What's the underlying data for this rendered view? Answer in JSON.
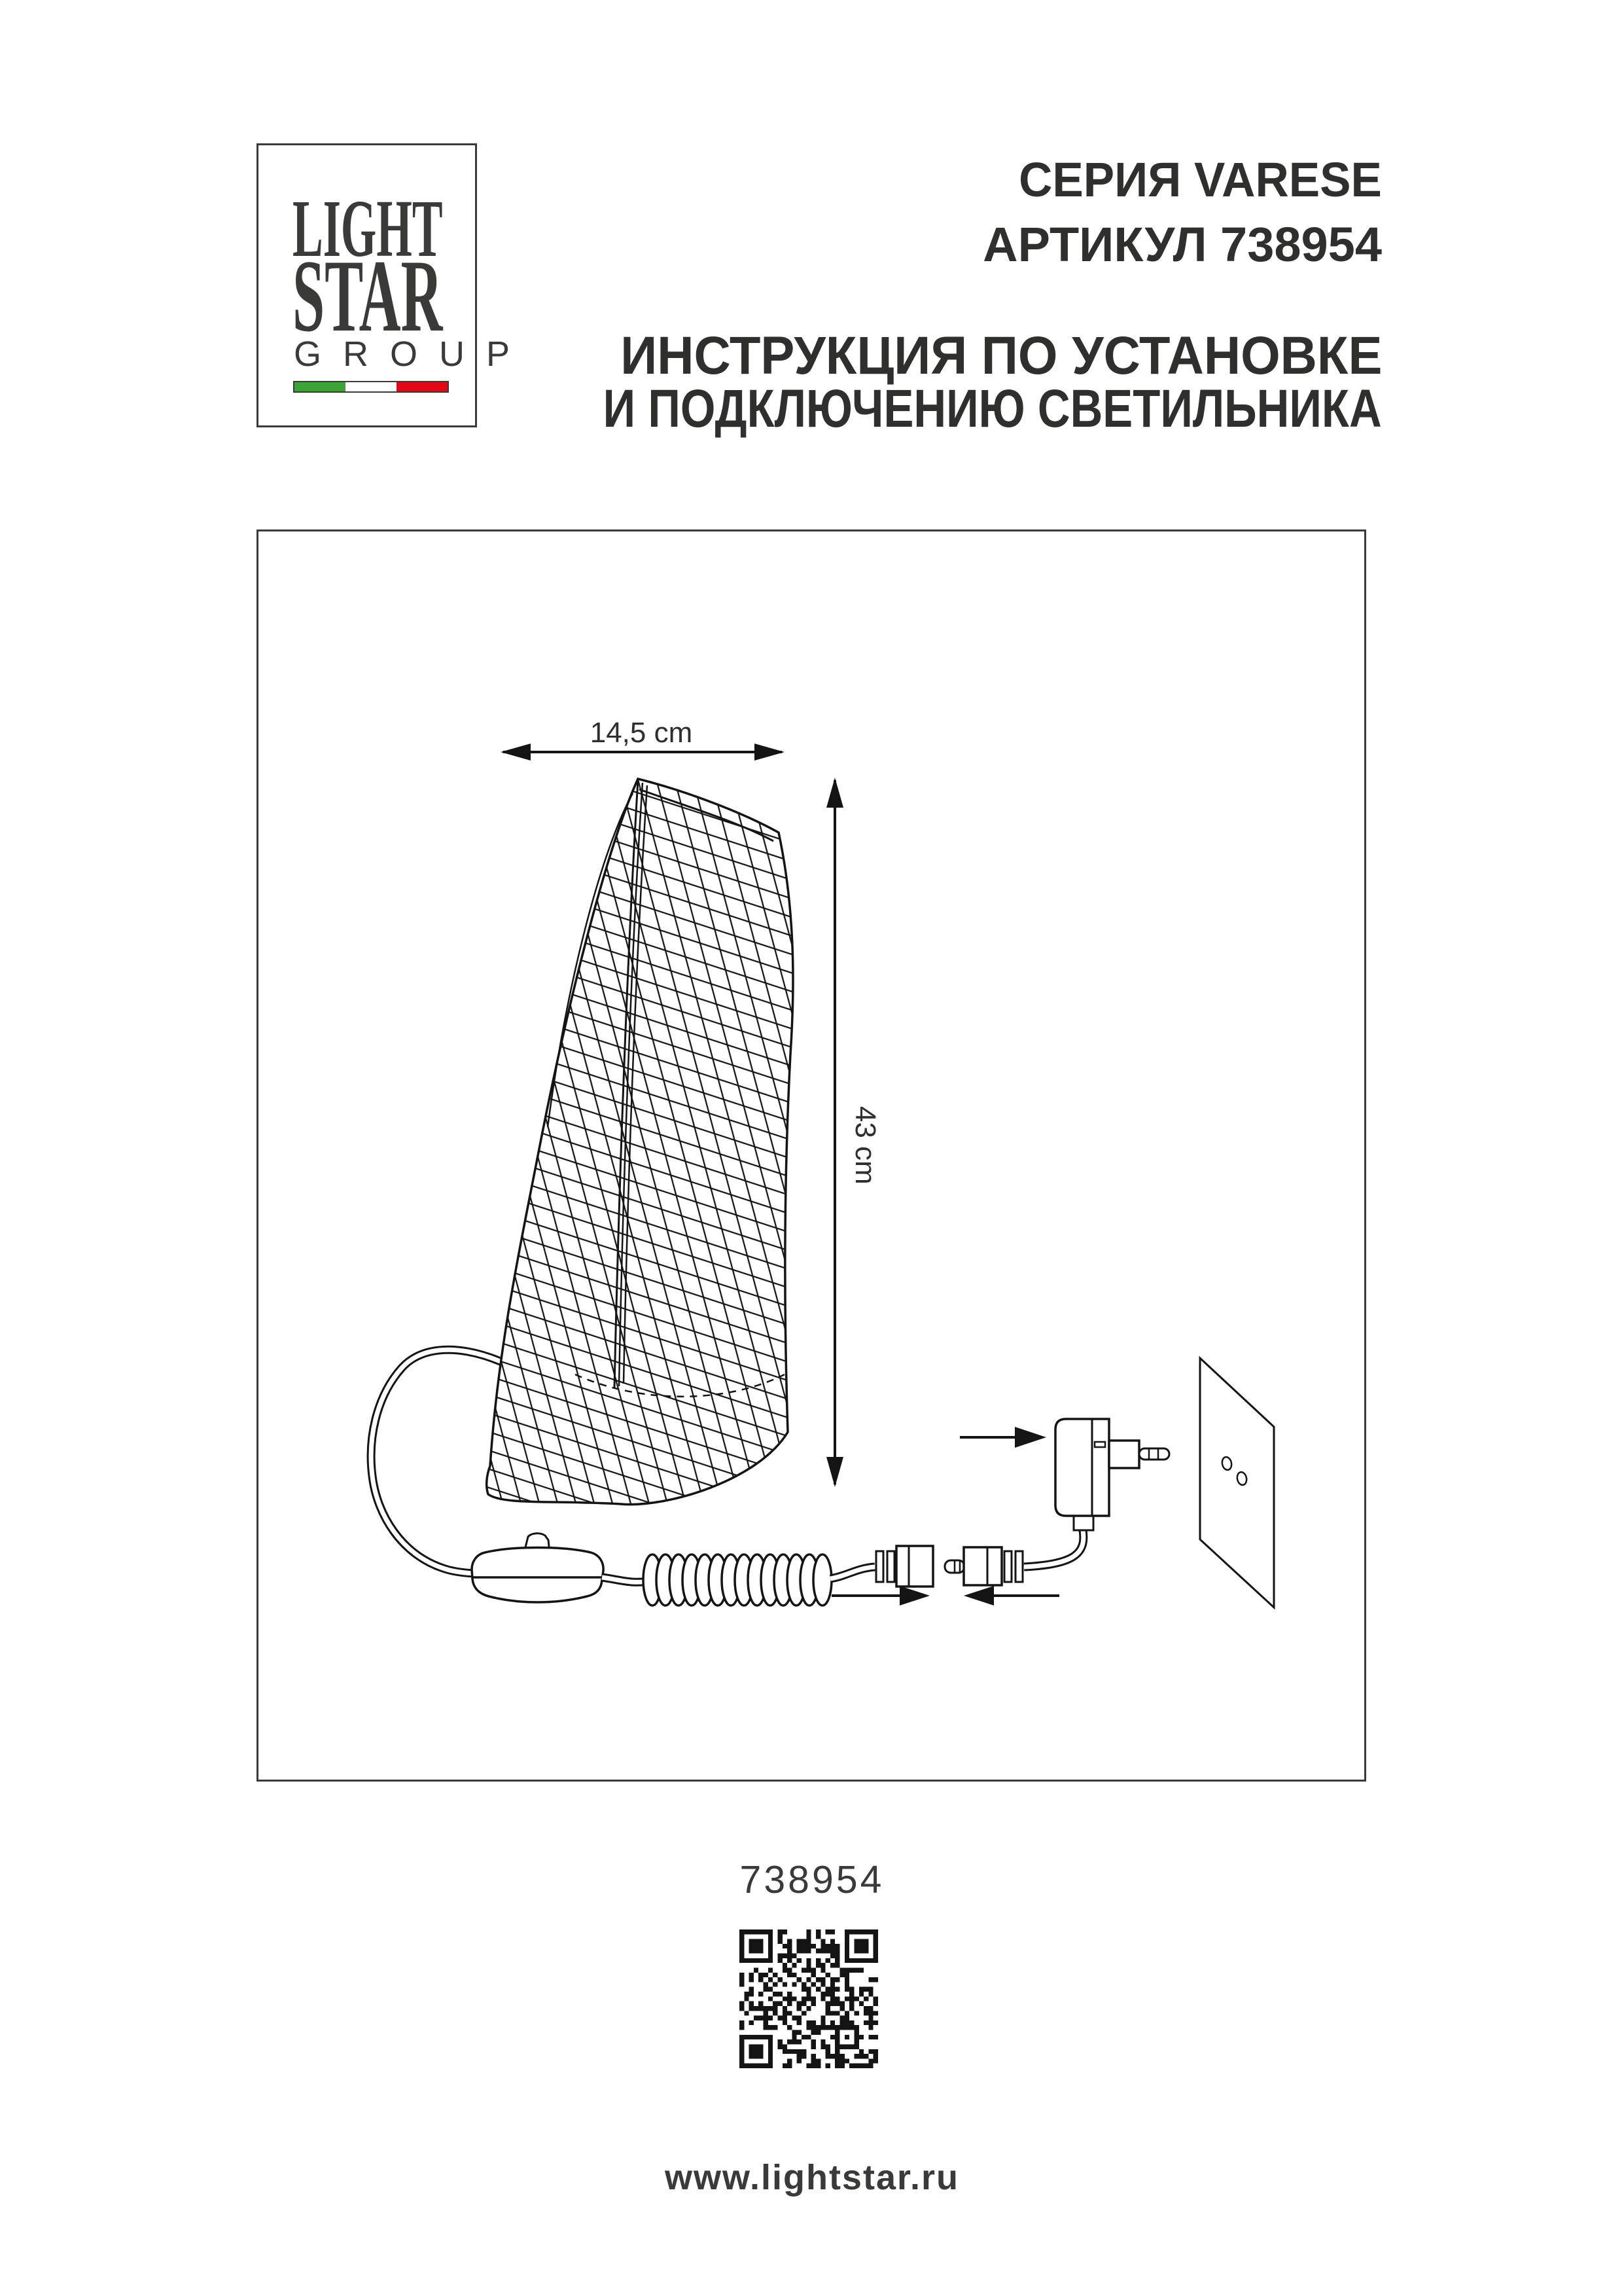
{
  "page": {
    "series_label": "СЕРИЯ VARESE",
    "article_label": "АРТИКУЛ 738954",
    "instruction_line1": "ИНСТРУКЦИЯ ПО УСТАНОВКЕ",
    "instruction_line2": "И ПОДКЛЮЧЕНИЮ СВЕТИЛЬНИКА",
    "article_number": "738954",
    "website": "www.lightstar.ru"
  },
  "logo": {
    "line1": "LIGHT",
    "line2": "STAR",
    "line3": "G R O U P",
    "flag_colors": [
      "#3aa535",
      "#ffffff",
      "#e30613"
    ]
  },
  "diagram": {
    "width_label": "14,5 cm",
    "height_label": "43 cm"
  },
  "colors": {
    "text": "#3a3a38",
    "line": "#141414",
    "flag_green": "#3aa535",
    "flag_red": "#e30613"
  },
  "qr": {
    "modules": 29,
    "seed": 738954
  }
}
